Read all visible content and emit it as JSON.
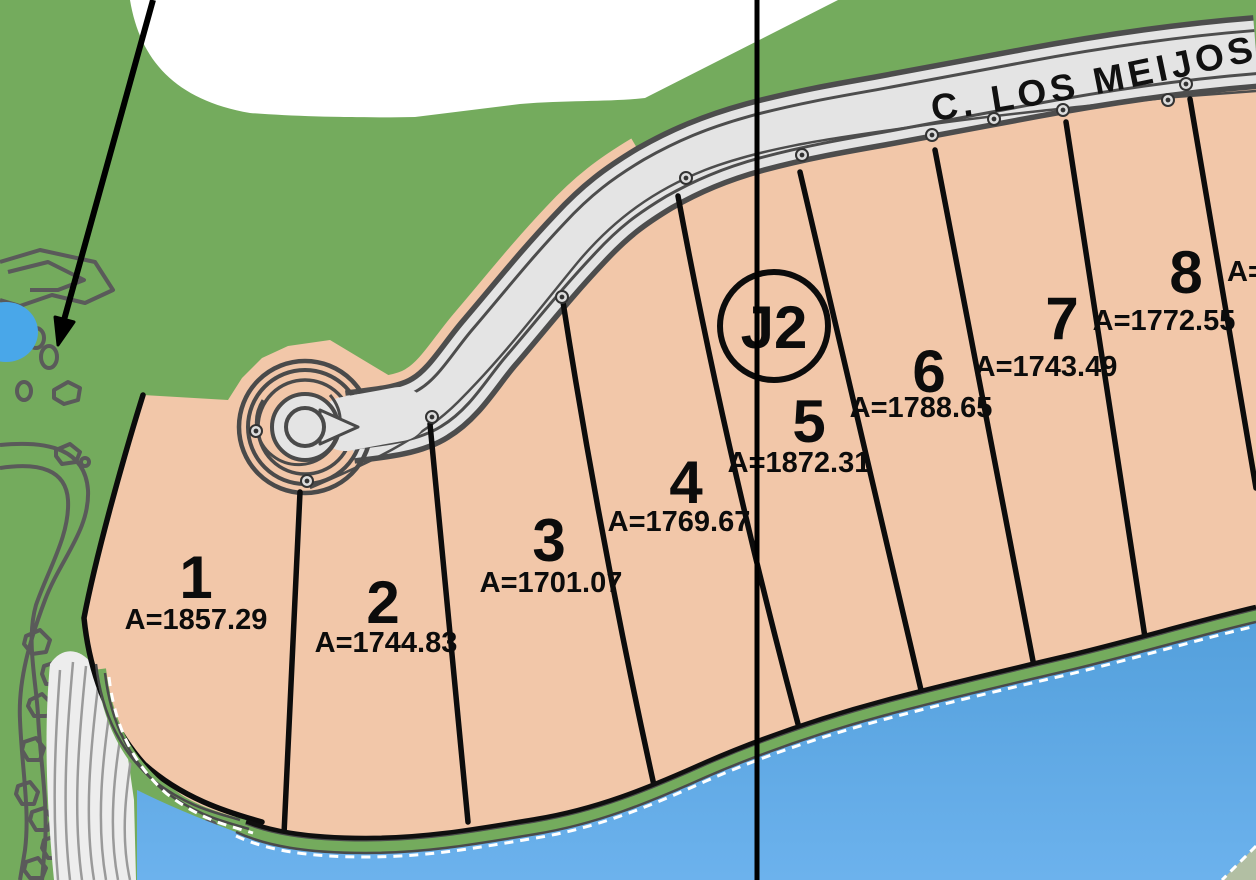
{
  "map": {
    "street": {
      "label": "C. LOS MEIJOS"
    },
    "block_badge": {
      "label": "J2"
    },
    "parcels": [
      {
        "number": "1",
        "area": "A=1857.29"
      },
      {
        "number": "2",
        "area": "A=1744.83"
      },
      {
        "number": "3",
        "area": "A=1701.07"
      },
      {
        "number": "4",
        "area": "A=1769.67"
      },
      {
        "number": "5",
        "area": "A=1872.31"
      },
      {
        "number": "6",
        "area": "A=1788.65"
      },
      {
        "number": "7",
        "area": "A=1743.49"
      },
      {
        "number": "8",
        "area": "A=1772.55"
      }
    ],
    "offscreen_parcel": {
      "partial_area_label": "A="
    },
    "colors": {
      "open_space_green": "#74ab5d",
      "parcel_salmon": "#f2c7a9",
      "water_blue": "#62aae4",
      "road_surface": "#e4e4e4",
      "road_casing": "#4d4d4d",
      "line_black": "#0c0c0c"
    }
  }
}
